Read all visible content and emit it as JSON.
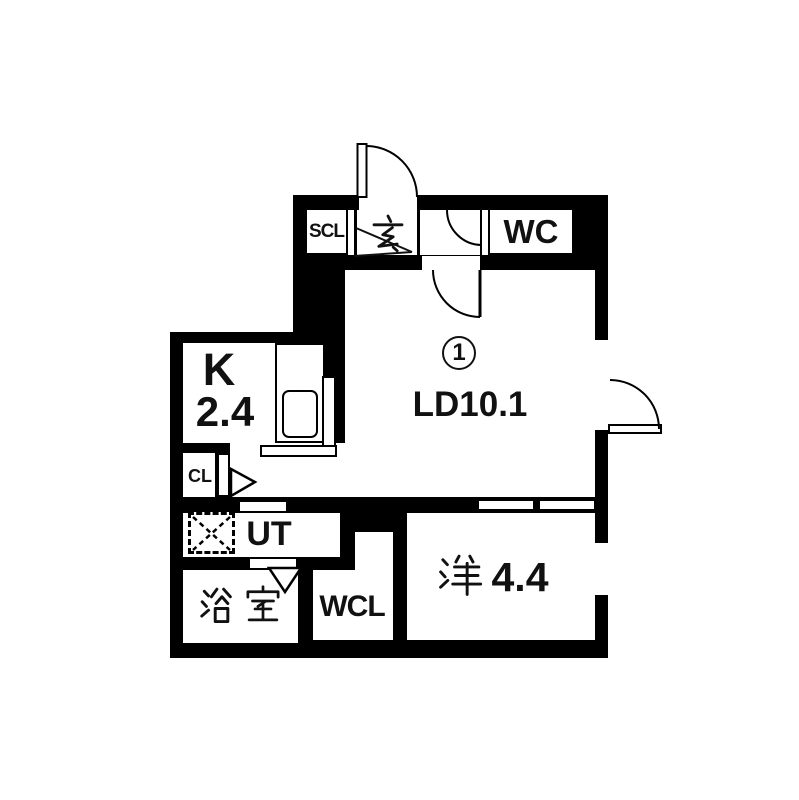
{
  "meta": {
    "type": "japanese-apartment-floor-plan",
    "colors": {
      "wall": "#000000",
      "background": "#ffffff",
      "line": "#111111"
    }
  },
  "unit": {
    "number": "1"
  },
  "rooms": {
    "shoes_closet": {
      "label": "SCL"
    },
    "genkan": {
      "label": "玄"
    },
    "wc": {
      "label": "WC"
    },
    "living_dining": {
      "label": "LD10.1",
      "name": "LD",
      "area": "10.1"
    },
    "kitchen": {
      "letter": "K",
      "area": "2.4"
    },
    "closet": {
      "label": "CL"
    },
    "utility": {
      "label": "UT"
    },
    "bathroom": {
      "label": "浴室"
    },
    "walk_in_closet": {
      "label": "WCL"
    },
    "western": {
      "kanji": "洋",
      "area": "4.4",
      "label": "洋4.4"
    }
  }
}
